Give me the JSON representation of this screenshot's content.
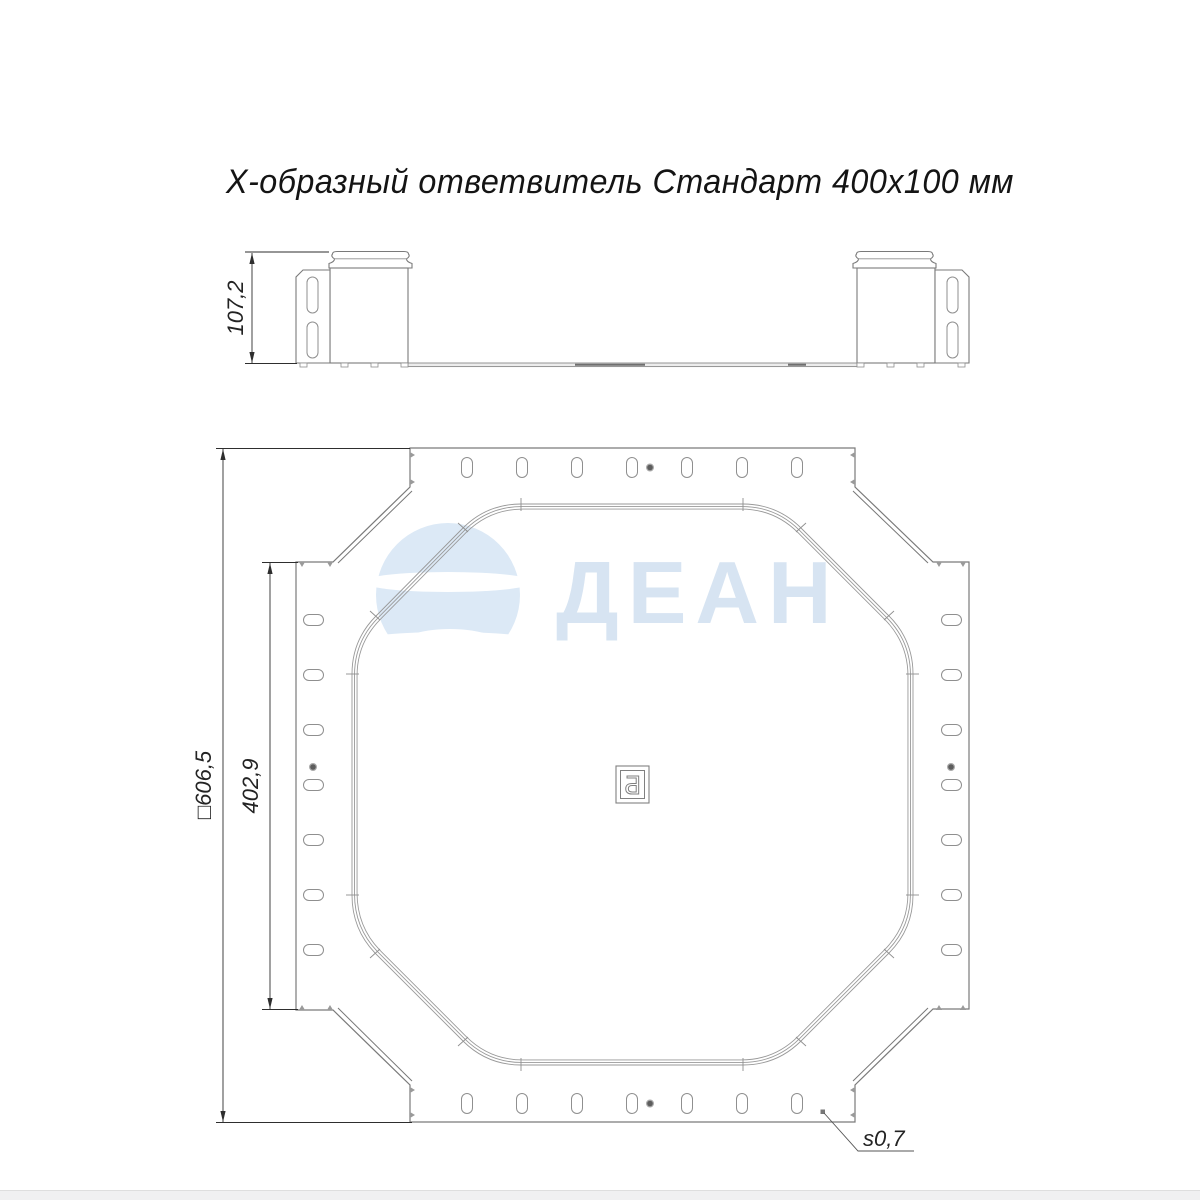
{
  "drawing": {
    "title": "Х-образный ответвитель Стандарт 400х100 мм",
    "side_view": {
      "height_dim": "107,2"
    },
    "plan_view": {
      "overall_dim": "□606,5",
      "flange_dim": "402,9",
      "thickness_dim": "s0,7",
      "center_mark_letter": "Б"
    },
    "watermark": {
      "text": "ДЕАН"
    },
    "colors": {
      "outline": "#7a7a7a",
      "thin_line": "#8f8f8f",
      "dimension": "#2e2e2e",
      "watermark_blue": "#dce9f6",
      "watermark_text": "#d7e4f2",
      "footer_strip": "#f0f0f1",
      "background": "#ffffff"
    }
  }
}
